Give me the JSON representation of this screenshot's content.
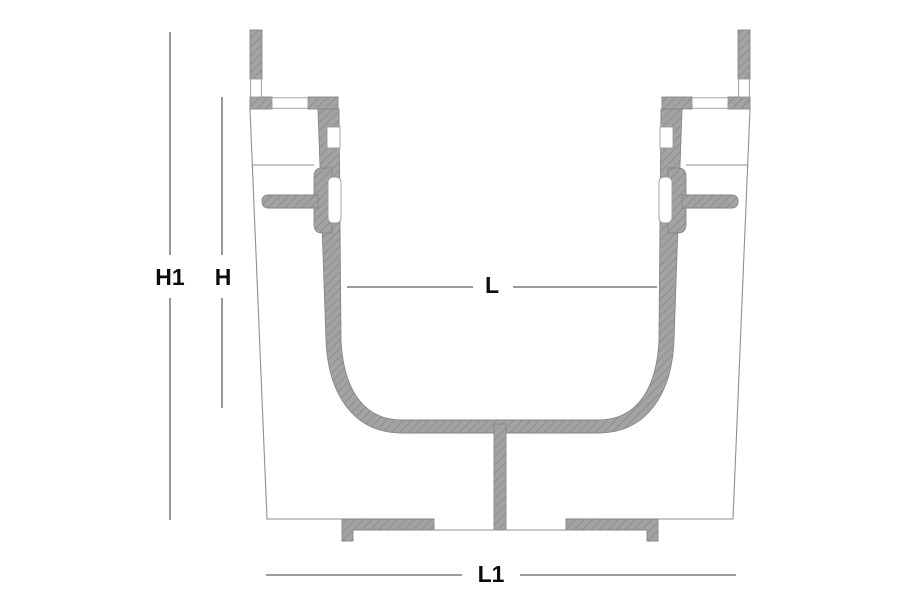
{
  "diagram": {
    "type": "channel-drain-cross-section",
    "dimensions": {
      "h1": {
        "label": "H1"
      },
      "h": {
        "label": "H"
      },
      "l": {
        "label": "L"
      },
      "l1": {
        "label": "L1"
      }
    },
    "colors": {
      "background": "#ffffff",
      "hatch_fill": "#a3a3a3",
      "hatch_line": "#8d8d8d",
      "outline": "#8f8f8f",
      "dimension_line": "#7d7d7d",
      "label_text": "#0c0c0c"
    }
  }
}
